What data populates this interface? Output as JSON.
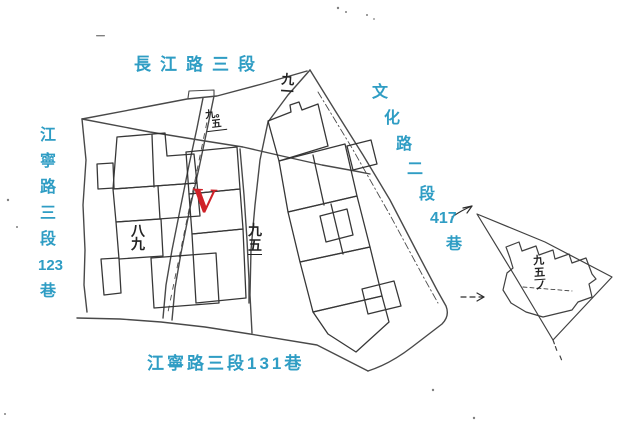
{
  "streets": {
    "top": {
      "label": "長江路三段"
    },
    "left": {
      "chars": [
        "江",
        "寧",
        "路",
        "三",
        "段",
        "123",
        "巷"
      ]
    },
    "right": {
      "chars": [
        "文",
        "化",
        "路",
        "二",
        "段",
        "417",
        "巷"
      ]
    },
    "bottom": {
      "label": "江寧路三段131巷"
    }
  },
  "parcels": {
    "p91": {
      "chars": [
        "九",
        "一"
      ]
    },
    "p905": {
      "chars": [
        "九。",
        "五"
      ]
    },
    "p89": {
      "chars": [
        "八",
        "九"
      ]
    },
    "p95": {
      "chars": [
        "九",
        "五"
      ]
    },
    "p951": {
      "chars": [
        "九",
        "五",
        "ノ"
      ]
    }
  },
  "marker": {
    "glyph": "V"
  },
  "colors": {
    "label_blue": "#2f9dc4",
    "marker_red": "#cf2128",
    "ink": "#222222",
    "linework": "#3a3a3a",
    "paper": "#ffffff"
  }
}
